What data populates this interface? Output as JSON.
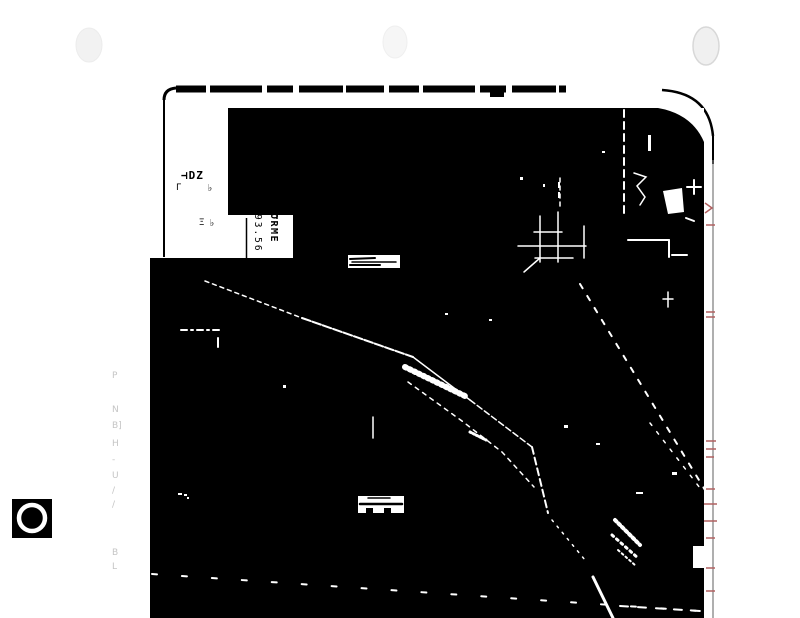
{
  "document": {
    "kind_label": "scanned map sheet (high-contrast photocopy)",
    "legend_box": {
      "fragment_1": "⊣DZ",
      "fragment_2": "Γ",
      "fragment_3": "♭",
      "fragment_4": "Ξ",
      "fragment_5": "♭"
    },
    "survey_label": {
      "value_column": "93.56",
      "name_column": "ORME"
    },
    "margin_column": {
      "chars": [
        "P",
        "N",
        "B]",
        "H",
        "-",
        "U",
        "/",
        "/",
        "B",
        "L"
      ]
    }
  },
  "colors": {
    "paper": "#ffffff",
    "ink": "#000000",
    "feature": "#ffffff",
    "margin_text": "#c5c5c5",
    "red_tick": "#b06060",
    "hole_punch": "#f2f2f2"
  }
}
